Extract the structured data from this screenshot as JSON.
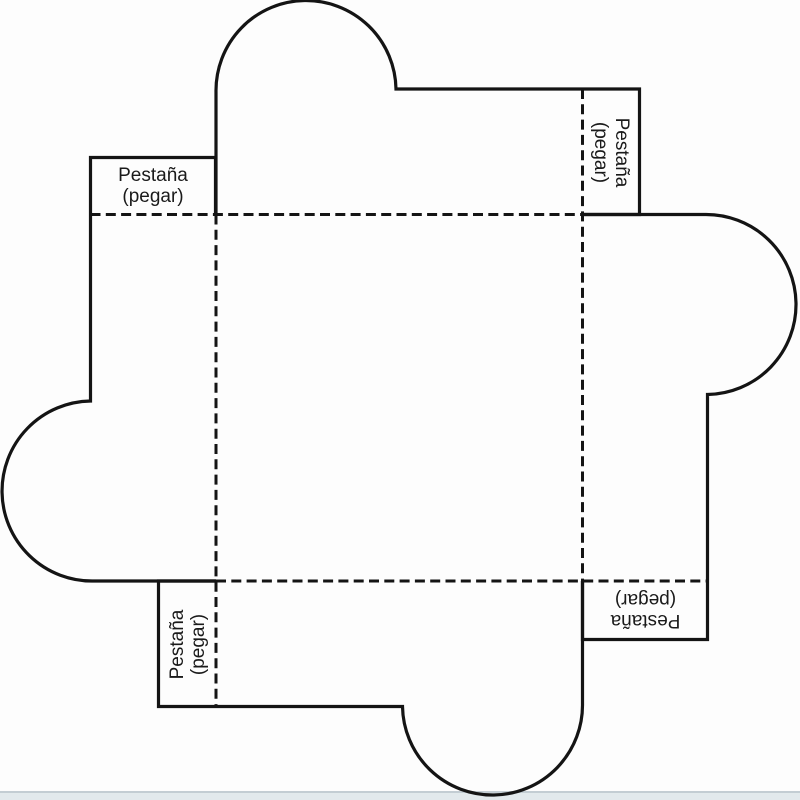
{
  "diagram": {
    "kind": "box-template-pattern",
    "colors": {
      "line": "#141414",
      "text": "#1a1a1a",
      "background": "#fdfdfd",
      "bottom_band": "#e2e9ec",
      "bottom_band_border": "#c3cdd3"
    },
    "labels": {
      "tabs": [
        {
          "position": "top-left",
          "line1": "Pestaña",
          "line2": "(pegar)"
        },
        {
          "position": "top-right",
          "line1": "Pestaña",
          "line2": "(pegar)"
        },
        {
          "position": "bottom-right",
          "line1": "Pestaña",
          "line2": "(pegar)"
        },
        {
          "position": "bottom-left",
          "line1": "Pestaña",
          "line2": "(pegar)"
        }
      ]
    }
  }
}
